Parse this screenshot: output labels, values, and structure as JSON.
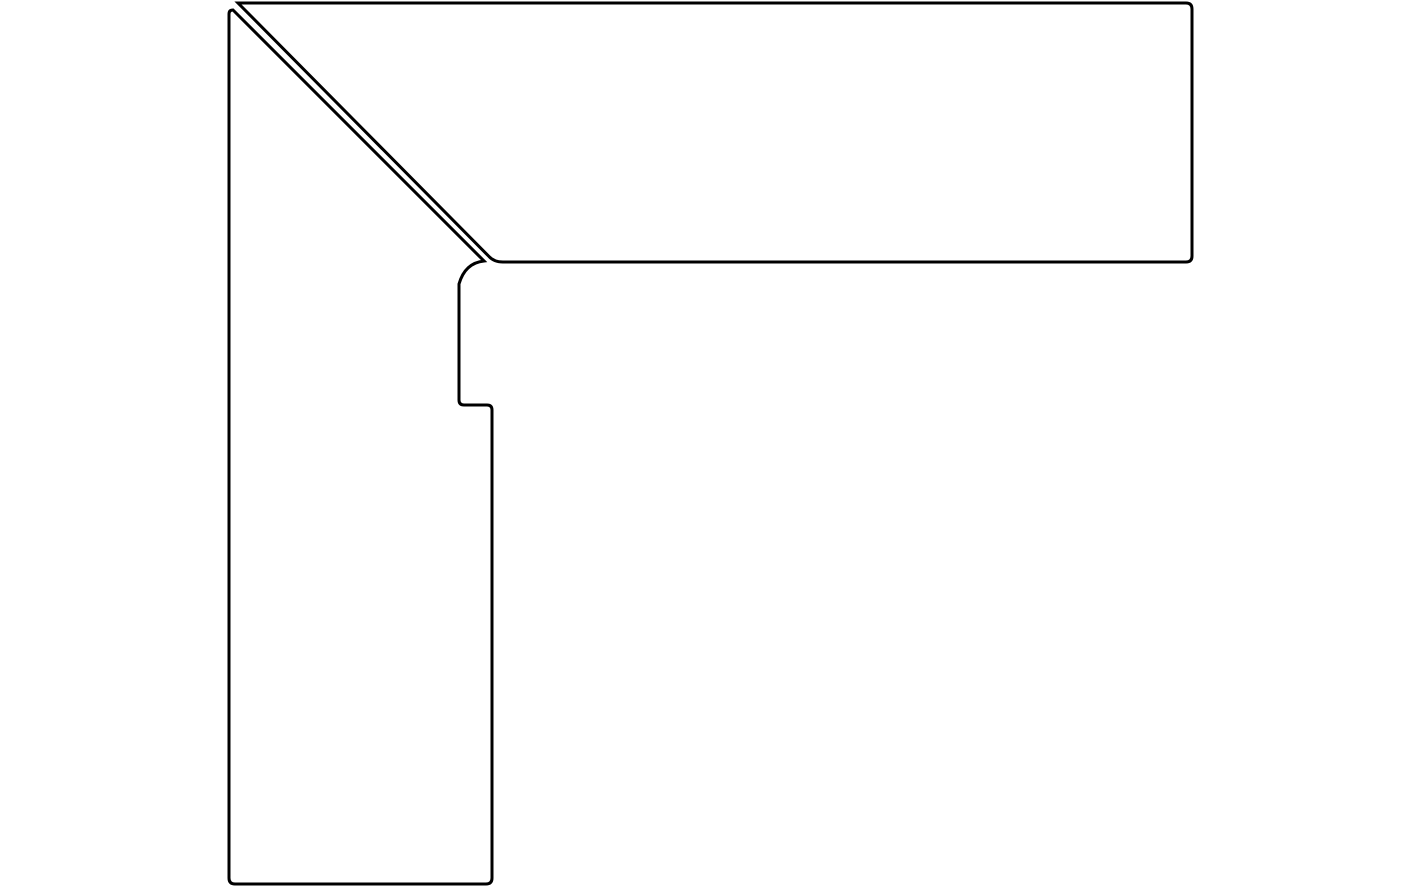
{
  "canvas": {
    "width": 1422,
    "height": 887,
    "viewbox": "0 0 1422 887",
    "background_color": "#ffffff"
  },
  "drawing": {
    "description": "Technical outline drawing of a two-piece corner profile (skirting/moulding corner) joined with a 45-degree mitre gap",
    "stroke_color": "#000000",
    "stroke_width": 3,
    "fill_color": "none",
    "pieces": [
      {
        "id": "top-horizontal-board",
        "path": "M 238 3 L 1186 3 Q 1192 3 1192 9 L 1192 256 Q 1192 262 1186 262 L 503 262 Q 494 262 489 256.5 Z"
      },
      {
        "id": "left-vertical-board",
        "path": "M 233 10 L 484 261 Q 465 263 459 284 L 459 400 Q 459 405 464 405 L 487 405 Q 492 405 492 410 L 492 878 Q 492 884 486 884 L 235 884 Q 229 884 229 878 L 229 14 Q 229 10 233 10 Z"
      }
    ]
  }
}
